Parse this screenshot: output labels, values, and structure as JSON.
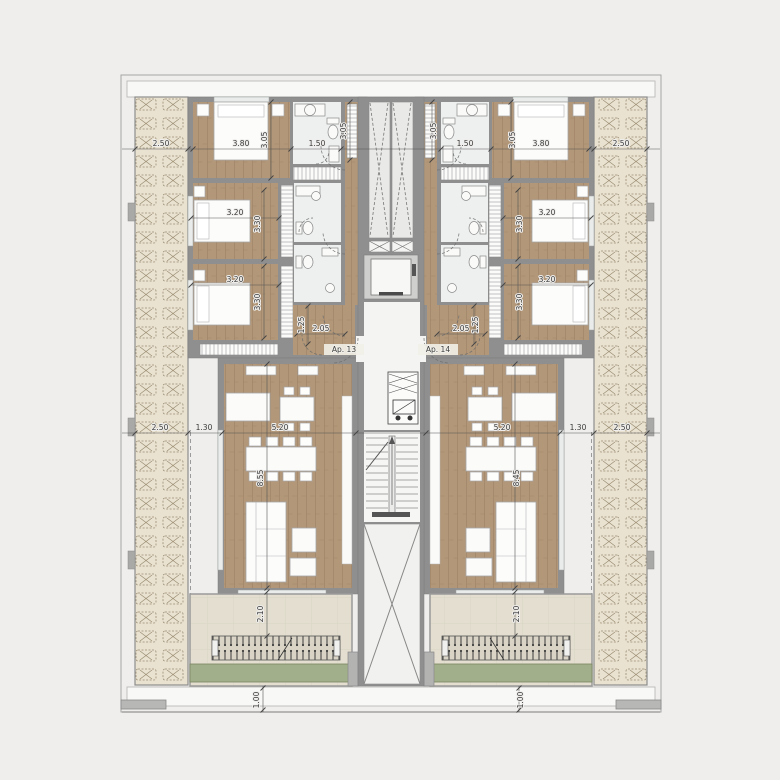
{
  "plan": {
    "apartment_left": "Ap. 13",
    "apartment_right": "Ap. 14"
  },
  "dims": {
    "deck_width": "2.50",
    "bedroom1_width": "3.80",
    "bedroom1_depth": "3.05",
    "bath_width": "1.50",
    "wardrobe_depth": "3.05",
    "bedroom2_width": "3.20",
    "bedroom2_depth": "3.30",
    "bedroom3_width": "3.20",
    "bedroom3_depth": "3.30",
    "hall_width": "2.05",
    "hall_depth": "1.25",
    "living_width": "5.20",
    "deck_gap": "1.30",
    "living_depth_left": "8.55",
    "living_depth_right": "8.45",
    "terrace_depth": "2.10",
    "edge_depth": "1.00"
  },
  "colors": {
    "background": "#efeeec",
    "wall": "#8f8f8f",
    "wood_floor": "#b29778",
    "deck": "#e9e2d1",
    "bath_floor": "#eef0ef",
    "core_floor": "#f4f4f2",
    "terrace_tile": "#e3decf",
    "green_strip": "#a2af8b",
    "dim_text": "#3a3a3a"
  }
}
